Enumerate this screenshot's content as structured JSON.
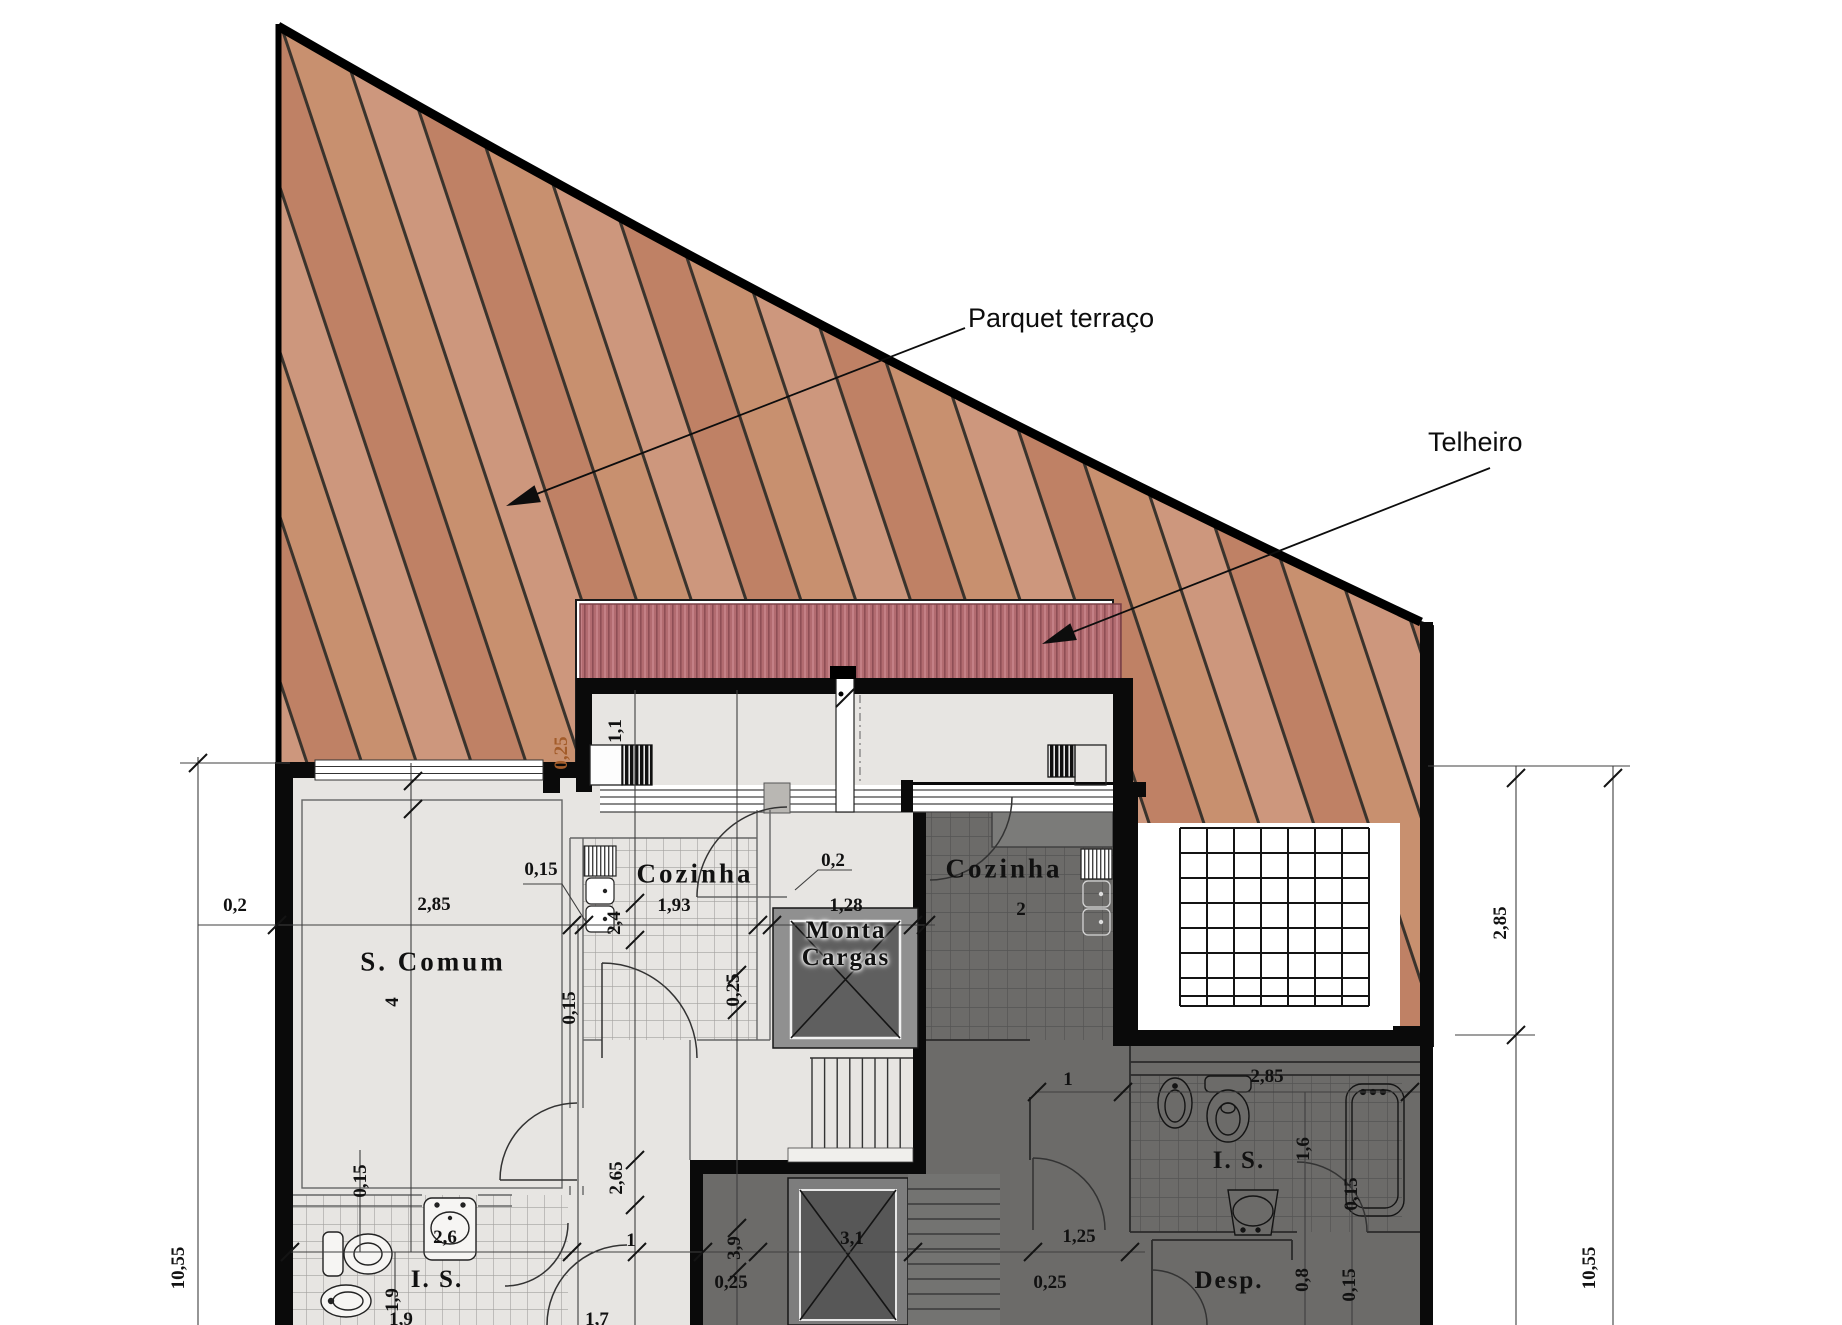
{
  "callouts": {
    "parquet": "Parquet terraço",
    "telheiro": "Telheiro"
  },
  "rooms": {
    "s_comum": "S. Comum",
    "s_comum_number": "4",
    "kitchen_left": "Cozinha",
    "kitchen_right": "Cozinha",
    "kitchen_right_number": "2",
    "lift_line1": "Monta",
    "lift_line2": "Cargas",
    "bathroom_left": "I. S.",
    "bathroom_right": "I. S.",
    "pantry": "Desp."
  },
  "dims_h": [
    "0,2",
    "2,85",
    "0,15",
    "1,93",
    "0,2",
    "1,28",
    "1",
    "2,6",
    "0,25",
    "3,1",
    "0,25",
    "1",
    "2,85",
    "1,25",
    "1,7",
    "1,9"
  ],
  "dims_v": [
    "2,4",
    "1,1",
    "0,25",
    "0,25",
    "0,15",
    "2,65",
    "0,15",
    "1,9",
    "3,9",
    "1,6",
    "0,15",
    "0,8",
    "0,15",
    "10,55",
    "2,85",
    "10,55"
  ],
  "colors": {
    "wood_base": "#c48a6e",
    "wood_plank_line": "#3a332c",
    "roof_base": "#b26b70",
    "roof_stripe_dark": "#8e4e55",
    "roof_stripe_light": "#c9868b",
    "light_room": "#e7e5e2",
    "dark_room": "#6c6b69",
    "wall": "#0a0a0a",
    "courtyard": "#ffffff",
    "dimension_text": "#111111",
    "orange_dim_text": "#a35c2a"
  }
}
